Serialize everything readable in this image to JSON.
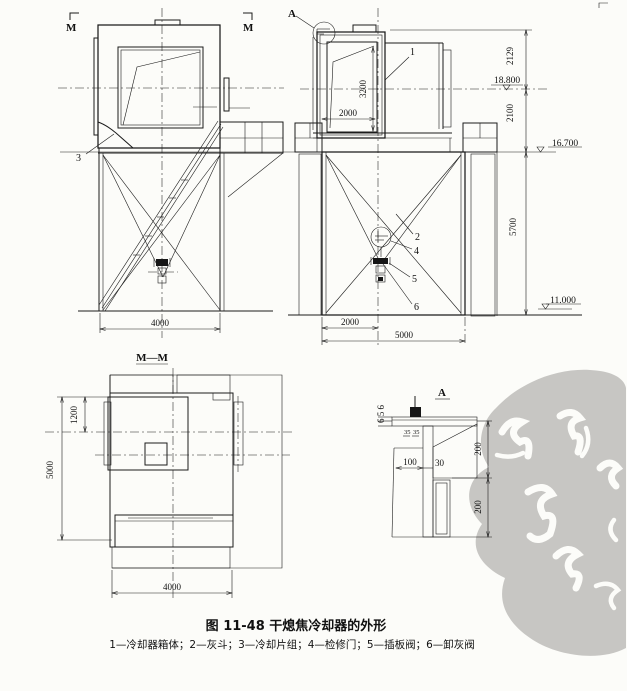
{
  "caption": {
    "title": "图 11-48  干熄焦冷却器的外形",
    "legend": "1—冷却器箱体；2—灰斗；3—冷却片组；4—检修门；5—插板阀；6—卸灰阀"
  },
  "markers": {
    "section_m_left": "M",
    "section_m_right": "M",
    "detail_a_label": "A",
    "section_view_title": "M—M",
    "detail_view_title": "A"
  },
  "parts": {
    "p1": "1",
    "p2": "2",
    "p3": "3",
    "p4": "4",
    "p5": "5",
    "p6": "6"
  },
  "levels": {
    "center": "18.800",
    "platform": "16.700",
    "ground": "11.000"
  },
  "dims": {
    "front_top": "2129",
    "front_mid": "2100",
    "front_lower": "5700",
    "door_height": "3200",
    "door_width": "2000",
    "base_half": "2000",
    "base_total": "5000",
    "left_base": "4000",
    "section_top_offset": "1200",
    "section_height": "5000",
    "section_width": "4000",
    "detail_plates": "6 5 6",
    "detail_gap_left": "35",
    "detail_gap_right": "35",
    "detail_w1": "100",
    "detail_w2": "30",
    "detail_h1": "200",
    "detail_h2": "200"
  }
}
